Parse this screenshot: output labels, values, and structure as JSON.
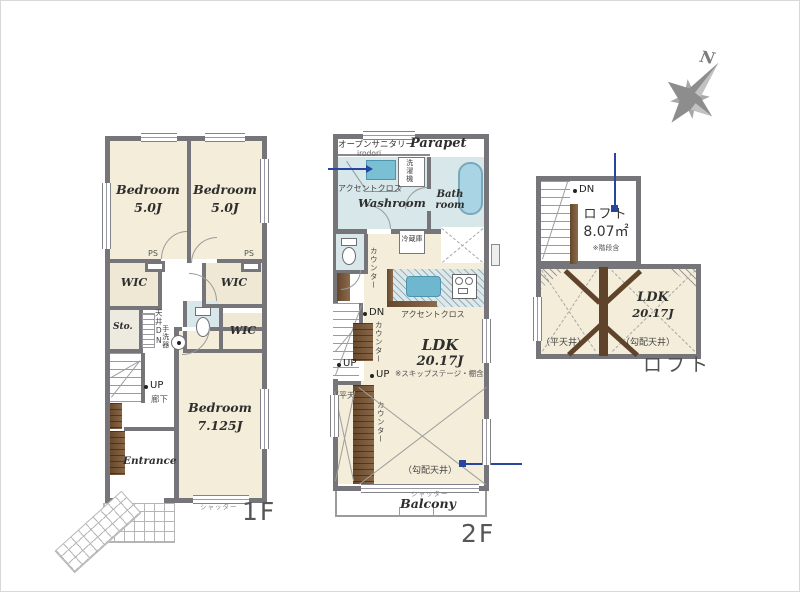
{
  "colors": {
    "wall": "#76757a",
    "floor": "#f3edd9",
    "wet_area": "#d7e7ea",
    "wood": "#7b5634",
    "accent_blue": "#27479e",
    "bathtub": "#a8d4e4"
  },
  "compass": {
    "north_label": "N"
  },
  "icons": {
    "compass-rose": "8-point star",
    "toilet-icon": "tank+bowl shape",
    "bathtub-icon": "rounded rect",
    "washer-icon": "labeled box"
  },
  "f1": {
    "floor_label": "1F",
    "bedroom1_name": "Bedroom",
    "bedroom1_size": "5.0J",
    "bedroom2_name": "Bedroom",
    "bedroom2_size": "5.0J",
    "bedroom3_name": "Bedroom",
    "bedroom3_size": "7.125J",
    "ps_left": "PS",
    "ps_right": "PS",
    "wic_left": "WIC",
    "wic_right_upper": "WIC",
    "wic_right_lower": "WIC",
    "storage": "Sto.",
    "attic_hatch": "天井DN",
    "hand_basin": "手洗器",
    "stairs_up": "UP",
    "hallway": "廊下",
    "entrance": "Entrance",
    "shutter": "シャッター"
  },
  "f2": {
    "floor_label": "2F",
    "open_sanitary": "オープンサニタリー",
    "vanity_model": "irodori",
    "parapet": "Parapet",
    "accent_cloth_washroom": "アクセントクロス",
    "washing_machine": "洗濯機",
    "washroom": "Washroom",
    "bathroom": "Bath room",
    "refrigerator": "冷蔵庫",
    "counter_upper": "カウンター",
    "counter_mid": "カウンター",
    "counter_lower": "カウンター",
    "stairs_dn": "DN",
    "stairs_up": "UP",
    "stage_up": "UP",
    "skip_stage_note": "※スキップステージ・棚含",
    "ldk_name": "LDK",
    "ldk_size": "20.17J",
    "accent_cloth_kitchen": "アクセントクロス",
    "flat_ceiling": "（平天井）",
    "sloped_ceiling": "（勾配天井）",
    "shutter": "シャッター",
    "balcony": "Balcony"
  },
  "loft": {
    "floor_label": "ロフト",
    "stairs_dn": "DN",
    "loft_name": "ロフト",
    "loft_area": "8.07㎡",
    "loft_note": "※階段含",
    "ldk_name": "LDK",
    "ldk_size": "20.17J",
    "flat_ceiling": "（平天井）",
    "sloped_ceiling": "（勾配天井）"
  }
}
